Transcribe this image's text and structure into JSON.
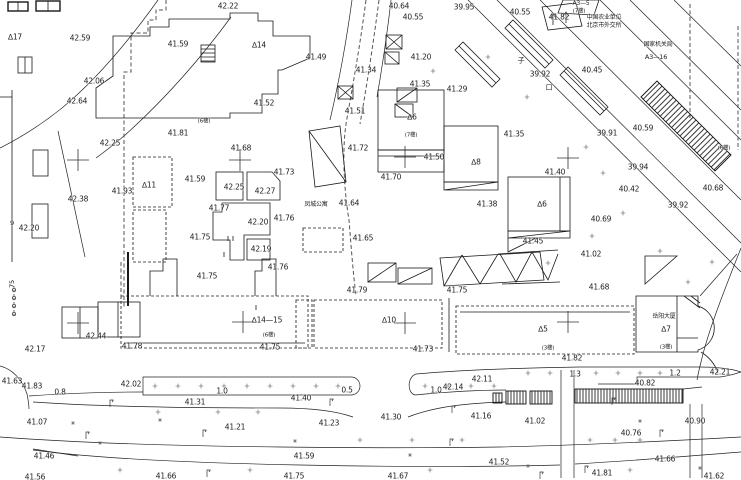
{
  "map": {
    "colors": {
      "ink": "#1c1c1c",
      "paper": "#ffffff"
    },
    "labels": [
      {
        "t": "42.22",
        "x": 228,
        "y": 6
      },
      {
        "t": "40.64",
        "x": 399,
        "y": 6
      },
      {
        "t": "40.55",
        "x": 413,
        "y": 17
      },
      {
        "t": "39.95",
        "x": 464,
        "y": 7
      },
      {
        "t": "40.55",
        "x": 520,
        "y": 12
      },
      {
        "t": "41.82",
        "x": 559,
        "y": 17
      },
      {
        "t": "A3—5",
        "x": 581,
        "y": 4,
        "s": 6,
        "k": "ref"
      },
      {
        "t": "(7楼)",
        "x": 579,
        "y": 12,
        "s": 5.5,
        "k": "floors"
      },
      {
        "t": "中国农业单位",
        "x": 604,
        "y": 18,
        "s": 6,
        "k": "bldg"
      },
      {
        "t": "北京市外交所",
        "x": 604,
        "y": 26,
        "s": 6,
        "k": "bldg"
      },
      {
        "t": "国家机关局",
        "x": 658,
        "y": 45,
        "s": 6,
        "k": "bldg"
      },
      {
        "t": "A3—16",
        "x": 656,
        "y": 57,
        "s": 6.5,
        "k": "ref"
      },
      {
        "t": "40.45",
        "x": 592,
        "y": 70
      },
      {
        "t": "39.92",
        "x": 540,
        "y": 74
      },
      {
        "t": "子",
        "x": 521,
        "y": 61,
        "s": 7,
        "k": "street"
      },
      {
        "t": "口",
        "x": 549,
        "y": 88,
        "s": 7,
        "k": "street"
      },
      {
        "t": "∆17",
        "x": 15,
        "y": 37,
        "k": "ref"
      },
      {
        "t": "42.59",
        "x": 80,
        "y": 38
      },
      {
        "t": "41.59",
        "x": 178,
        "y": 44
      },
      {
        "t": "∆14",
        "x": 259,
        "y": 45,
        "k": "ref"
      },
      {
        "t": "41.49",
        "x": 316,
        "y": 57
      },
      {
        "t": "41.20",
        "x": 421,
        "y": 57
      },
      {
        "t": "41.34",
        "x": 366,
        "y": 70
      },
      {
        "t": "41.35",
        "x": 420,
        "y": 84
      },
      {
        "t": "41.29",
        "x": 457,
        "y": 89
      },
      {
        "t": "42.06",
        "x": 94,
        "y": 81
      },
      {
        "t": "42.64",
        "x": 77,
        "y": 101
      },
      {
        "t": "41.52",
        "x": 264,
        "y": 103
      },
      {
        "t": "41.51",
        "x": 355,
        "y": 111
      },
      {
        "t": "∆6",
        "x": 412,
        "y": 117,
        "k": "ref"
      },
      {
        "t": "(7楼)",
        "x": 411,
        "y": 136,
        "s": 5.5,
        "k": "floors"
      },
      {
        "t": "42.25",
        "x": 110,
        "y": 143
      },
      {
        "t": "41.81",
        "x": 178,
        "y": 133
      },
      {
        "t": "(6楼)",
        "x": 204,
        "y": 122,
        "s": 5.5,
        "k": "floors"
      },
      {
        "t": "41.68",
        "x": 241,
        "y": 148
      },
      {
        "t": "41.35",
        "x": 514,
        "y": 134
      },
      {
        "t": "39.91",
        "x": 607,
        "y": 133
      },
      {
        "t": "40.59",
        "x": 643,
        "y": 128
      },
      {
        "t": "(6楼)",
        "x": 724,
        "y": 149,
        "s": 5.5,
        "k": "floors"
      },
      {
        "t": "41.72",
        "x": 358,
        "y": 148
      },
      {
        "t": "41.50",
        "x": 434,
        "y": 157
      },
      {
        "t": "∆8",
        "x": 476,
        "y": 162,
        "k": "ref"
      },
      {
        "t": "41.40",
        "x": 555,
        "y": 172
      },
      {
        "t": "39.94",
        "x": 638,
        "y": 167
      },
      {
        "t": "40.42",
        "x": 629,
        "y": 189
      },
      {
        "t": "40.68",
        "x": 713,
        "y": 188
      },
      {
        "t": "39.92",
        "x": 678,
        "y": 205
      },
      {
        "t": "41.93",
        "x": 122,
        "y": 191
      },
      {
        "t": "∆11",
        "x": 149,
        "y": 185,
        "k": "ref"
      },
      {
        "t": "41.59",
        "x": 195,
        "y": 179
      },
      {
        "t": "41.73",
        "x": 284,
        "y": 172
      },
      {
        "t": "42.25",
        "x": 234,
        "y": 187
      },
      {
        "t": "42.27",
        "x": 265,
        "y": 191
      },
      {
        "t": "42.38",
        "x": 78,
        "y": 199
      },
      {
        "t": "41.77",
        "x": 219,
        "y": 208
      },
      {
        "t": "42.20",
        "x": 258,
        "y": 222
      },
      {
        "t": "41.76",
        "x": 284,
        "y": 218
      },
      {
        "t": "41.70",
        "x": 391,
        "y": 177
      },
      {
        "t": "41.64",
        "x": 349,
        "y": 203
      },
      {
        "t": "凤城公寓",
        "x": 316,
        "y": 205,
        "s": 6,
        "k": "bldg"
      },
      {
        "t": "41.38",
        "x": 487,
        "y": 204
      },
      {
        "t": "∆6",
        "x": 542,
        "y": 204,
        "k": "ref"
      },
      {
        "t": "40.69",
        "x": 601,
        "y": 219
      },
      {
        "t": "42.20",
        "x": 29,
        "y": 228
      },
      {
        "t": "9",
        "x": 12,
        "y": 223,
        "s": 6.5
      },
      {
        "t": "41.75",
        "x": 200,
        "y": 237
      },
      {
        "t": "42.19",
        "x": 261,
        "y": 249
      },
      {
        "t": "41.65",
        "x": 363,
        "y": 238
      },
      {
        "t": "41.45",
        "x": 533,
        "y": 241
      },
      {
        "t": "41.76",
        "x": 278,
        "y": 267
      },
      {
        "t": "41.75",
        "x": 207,
        "y": 276
      },
      {
        "t": "41.02",
        "x": 591,
        "y": 254
      },
      {
        "t": "41.79",
        "x": 357,
        "y": 290
      },
      {
        "t": "41.75",
        "x": 457,
        "y": 290
      },
      {
        "t": "41.68",
        "x": 599,
        "y": 287
      },
      {
        "t": "∆14—15",
        "x": 267,
        "y": 320,
        "k": "ref"
      },
      {
        "t": "(6楼)",
        "x": 269,
        "y": 336,
        "s": 5.5,
        "k": "floors"
      },
      {
        "t": "∆10",
        "x": 389,
        "y": 320,
        "k": "ref"
      },
      {
        "t": "∆5",
        "x": 543,
        "y": 329,
        "k": "ref"
      },
      {
        "t": "(3楼)",
        "x": 548,
        "y": 349,
        "s": 5.5,
        "k": "floors"
      },
      {
        "t": "41.82",
        "x": 572,
        "y": 358
      },
      {
        "t": "岳阳大厦",
        "x": 664,
        "y": 317,
        "s": 6,
        "k": "bldg"
      },
      {
        "t": "∆7",
        "x": 666,
        "y": 329,
        "k": "ref"
      },
      {
        "t": "(3楼)",
        "x": 666,
        "y": 348,
        "s": 5.5,
        "k": "floors"
      },
      {
        "t": "42.44",
        "x": 96,
        "y": 336
      },
      {
        "t": "42.17",
        "x": 35,
        "y": 349
      },
      {
        "t": "41.78",
        "x": 132,
        "y": 346
      },
      {
        "t": "41.73",
        "x": 423,
        "y": 349
      },
      {
        "t": "41.75",
        "x": 270,
        "y": 347
      },
      {
        "t": "75",
        "x": 12,
        "y": 284,
        "r": -90,
        "s": 6.5
      },
      {
        "t": "41.63",
        "x": 12,
        "y": 381
      },
      {
        "t": "41.83",
        "x": 32,
        "y": 386
      },
      {
        "t": "42.02",
        "x": 131,
        "y": 384
      },
      {
        "t": "0.8",
        "x": 60,
        "y": 392,
        "k": "dist"
      },
      {
        "t": "1.0",
        "x": 222,
        "y": 391,
        "k": "dist"
      },
      {
        "t": "41.31",
        "x": 195,
        "y": 402
      },
      {
        "t": "41.40",
        "x": 301,
        "y": 398
      },
      {
        "t": "0.5",
        "x": 347,
        "y": 390,
        "k": "dist"
      },
      {
        "t": "1.0",
        "x": 436,
        "y": 390,
        "k": "dist"
      },
      {
        "t": "42.14",
        "x": 453,
        "y": 387
      },
      {
        "t": "42.11",
        "x": 482,
        "y": 379
      },
      {
        "t": "1.3",
        "x": 575,
        "y": 374,
        "k": "dist"
      },
      {
        "t": "1.2",
        "x": 675,
        "y": 373,
        "k": "dist"
      },
      {
        "t": "42.21",
        "x": 720,
        "y": 372
      },
      {
        "t": "40.82",
        "x": 645,
        "y": 383
      },
      {
        "t": "41.07",
        "x": 37,
        "y": 422
      },
      {
        "t": "41.21",
        "x": 235,
        "y": 427
      },
      {
        "t": "41.23",
        "x": 329,
        "y": 423
      },
      {
        "t": "41.30",
        "x": 391,
        "y": 417
      },
      {
        "t": "41.16",
        "x": 481,
        "y": 416
      },
      {
        "t": "41.02",
        "x": 535,
        "y": 421
      },
      {
        "t": "40.90",
        "x": 695,
        "y": 421
      },
      {
        "t": "40.76",
        "x": 631,
        "y": 433
      },
      {
        "t": "41.46",
        "x": 44,
        "y": 456
      },
      {
        "t": "41.59",
        "x": 304,
        "y": 456
      },
      {
        "t": "41.52",
        "x": 499,
        "y": 462
      },
      {
        "t": "41.66",
        "x": 665,
        "y": 459
      },
      {
        "t": "41.56",
        "x": 35,
        "y": 477
      },
      {
        "t": "41.66",
        "x": 166,
        "y": 476
      },
      {
        "t": "41.75",
        "x": 294,
        "y": 476
      },
      {
        "t": "41.67",
        "x": 398,
        "y": 476
      },
      {
        "t": "41.81",
        "x": 602,
        "y": 473
      },
      {
        "t": "41.62",
        "x": 714,
        "y": 476
      }
    ]
  }
}
